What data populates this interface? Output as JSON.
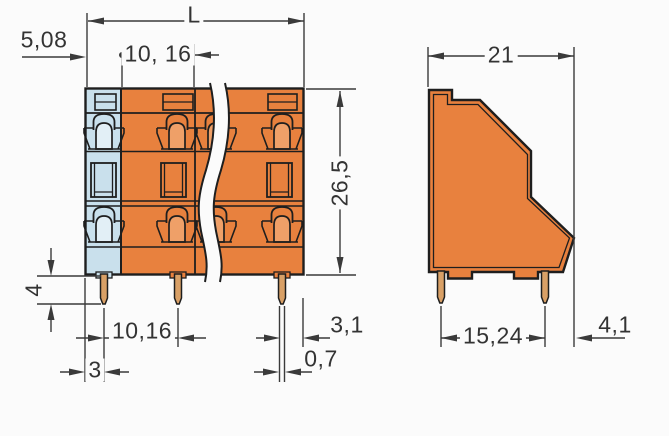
{
  "document": {
    "kind": "dimensional technical drawing",
    "subject": "double-deck PCB terminal block, front and side views with break symbol"
  },
  "dimensions": {
    "d_508": {
      "label": "5,08"
    },
    "d_L": {
      "label": "L"
    },
    "d_1016_top": {
      "label": "10, 16"
    },
    "d_265": {
      "label": "26,5"
    },
    "d_4": {
      "label": "4"
    },
    "d_1016_bot": {
      "label": "10,16"
    },
    "d_3": {
      "label": "3"
    },
    "d_31": {
      "label": "3,1"
    },
    "d_07": {
      "label": "0,7"
    },
    "d_21": {
      "label": "21"
    },
    "d_1524": {
      "label": "15,24"
    },
    "d_41": {
      "label": "4,1"
    }
  },
  "colors": {
    "body_orange": "#E8813E",
    "end_blue": "#C9E0EC",
    "bell_orange": "#EFA068",
    "bell_blue": "#E2EFF6",
    "pin_tan": "#D9A066",
    "outline": "#1E1E1E",
    "dim": "#3A3A3A",
    "dim_text": "#333333",
    "bg": "#FBFBFB"
  }
}
